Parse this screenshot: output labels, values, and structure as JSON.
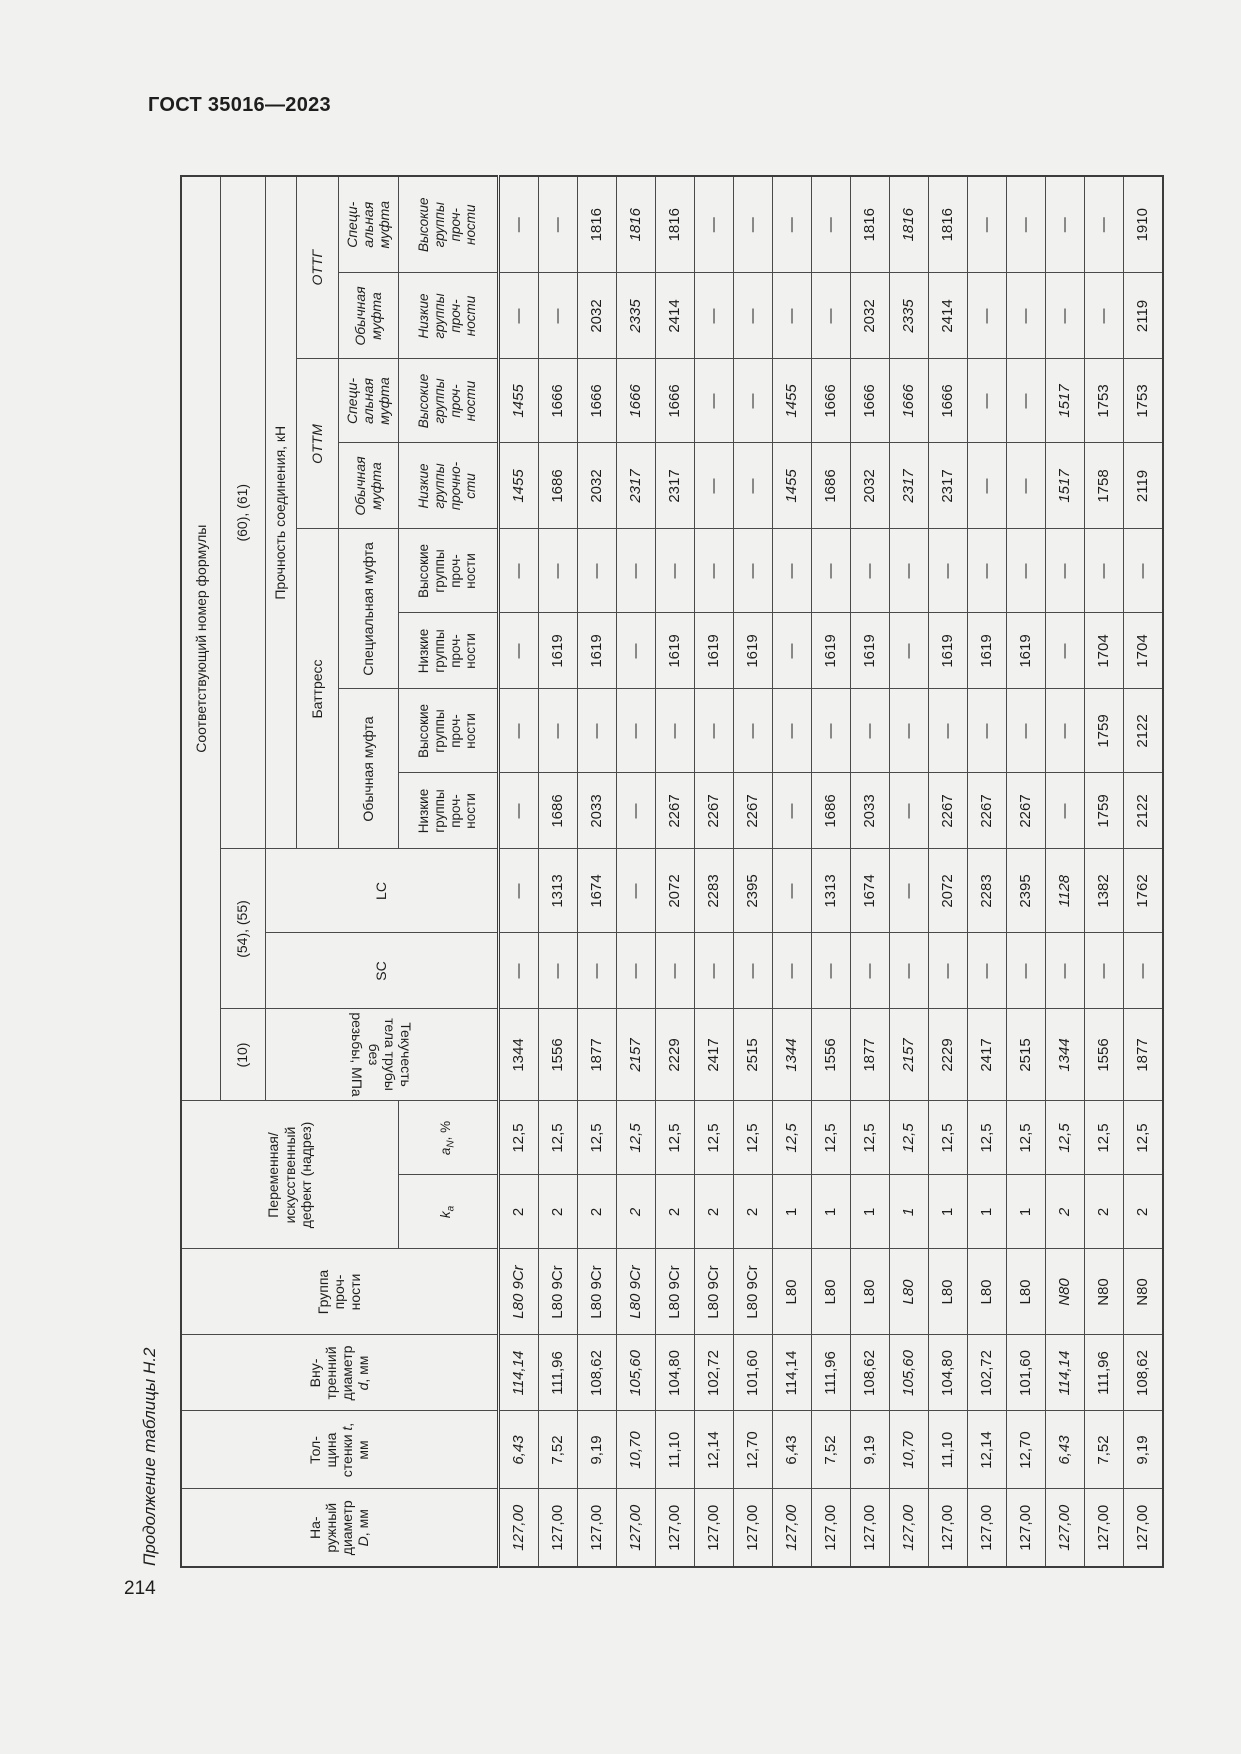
{
  "page": {
    "standard": "ГОСТ 35016—2023",
    "caption": "Продолжение таблицы Н.2",
    "number": "214"
  },
  "table": {
    "header": {
      "outer": {
        "pre": "На-\nружный\nдиаметр\n",
        "sym": "D",
        "post": ", мм"
      },
      "wall": {
        "pre": "Тол-\nщина\nстенки ",
        "sym": "t",
        "post": ",\nмм"
      },
      "inner": {
        "pre": "Вну-\nтренний\nдиаметр\n",
        "sym": "d",
        "post": ", мм"
      },
      "grade": "Группа\nпроч-\nности",
      "defect": "Переменная/\nискусственный\nдефект (надрез)",
      "ka": {
        "sym": "k",
        "sub": "а"
      },
      "an": {
        "sym": "a",
        "sub": "N",
        "post": ", %"
      },
      "formula_title": "Соответствующий номер формулы",
      "f10": "(10)",
      "f54_55": "(54), (55)",
      "f60_61": "(60), (61)",
      "yield": "Текучесть тела трубы без\nрезьбы, МПа",
      "sc": "SC",
      "lc": "LC",
      "strength": "Прочность соединения, кН",
      "buttress": "Баттресс",
      "ottm": "ОТТМ",
      "ottg": "ОТТГ",
      "usual1": "Обычная муфта",
      "special1": "Специальная муфта",
      "usual2": "Обычная\nмуфта",
      "special2": "Специ-\nальная\nмуфта",
      "low": "Низкие\nгруппы\nпроч-\nности",
      "high": "Высокие\nгруппы\nпроч-\nности",
      "low_b": "Низкие\nгруппы\nпрочно-\nсти"
    },
    "rows": [
      {
        "cells": [
          "127,00",
          "6,43",
          "114,14",
          "L80 9Cr",
          "2",
          "12,5",
          "1344",
          "—",
          "—",
          "—",
          "—",
          "—",
          "—",
          "1455",
          "1455",
          "—",
          "—"
        ],
        "italics": [
          1,
          1,
          1,
          1,
          0,
          0,
          0,
          0,
          0,
          0,
          0,
          0,
          0,
          1,
          1,
          0,
          0
        ]
      },
      {
        "cells": [
          "127,00",
          "7,52",
          "111,96",
          "L80 9Cr",
          "2",
          "12,5",
          "1556",
          "—",
          "1313",
          "1686",
          "—",
          "1619",
          "—",
          "1686",
          "1666",
          "—",
          "—"
        ],
        "italics": [
          0,
          0,
          0,
          0,
          0,
          0,
          0,
          0,
          0,
          0,
          0,
          0,
          0,
          0,
          0,
          0,
          0
        ]
      },
      {
        "cells": [
          "127,00",
          "9,19",
          "108,62",
          "L80 9Cr",
          "2",
          "12,5",
          "1877",
          "—",
          "1674",
          "2033",
          "—",
          "1619",
          "—",
          "2032",
          "1666",
          "2032",
          "1816"
        ],
        "italics": [
          0,
          0,
          0,
          0,
          0,
          0,
          0,
          0,
          0,
          0,
          0,
          0,
          0,
          0,
          0,
          0,
          0
        ]
      },
      {
        "cells": [
          "127,00",
          "10,70",
          "105,60",
          "L80 9Cr",
          "2",
          "12,5",
          "2157",
          "—",
          "—",
          "—",
          "—",
          "—",
          "—",
          "2317",
          "1666",
          "2335",
          "1816"
        ],
        "italics": [
          1,
          1,
          1,
          1,
          1,
          1,
          1,
          0,
          0,
          0,
          0,
          0,
          0,
          1,
          1,
          1,
          1
        ]
      },
      {
        "cells": [
          "127,00",
          "11,10",
          "104,80",
          "L80 9Cr",
          "2",
          "12,5",
          "2229",
          "—",
          "2072",
          "2267",
          "—",
          "1619",
          "—",
          "2317",
          "1666",
          "2414",
          "1816"
        ],
        "italics": [
          0,
          0,
          0,
          0,
          0,
          0,
          0,
          0,
          0,
          0,
          0,
          0,
          0,
          0,
          0,
          0,
          0
        ]
      },
      {
        "cells": [
          "127,00",
          "12,14",
          "102,72",
          "L80 9Cr",
          "2",
          "12,5",
          "2417",
          "—",
          "2283",
          "2267",
          "—",
          "1619",
          "—",
          "—",
          "—",
          "—",
          "—"
        ],
        "italics": [
          0,
          0,
          0,
          0,
          0,
          0,
          0,
          0,
          0,
          0,
          0,
          0,
          0,
          0,
          0,
          0,
          0
        ]
      },
      {
        "cells": [
          "127,00",
          "12,70",
          "101,60",
          "L80 9Cr",
          "2",
          "12,5",
          "2515",
          "—",
          "2395",
          "2267",
          "—",
          "1619",
          "—",
          "—",
          "—",
          "—",
          "—"
        ],
        "italics": [
          0,
          0,
          0,
          0,
          0,
          0,
          0,
          0,
          0,
          0,
          0,
          0,
          0,
          0,
          0,
          0,
          0
        ]
      },
      {
        "cells": [
          "127,00",
          "6,43",
          "114,14",
          "L80",
          "1",
          "12,5",
          "1344",
          "—",
          "—",
          "—",
          "—",
          "—",
          "—",
          "1455",
          "1455",
          "—",
          "—"
        ],
        "italics": [
          1,
          0,
          0,
          0,
          0,
          1,
          1,
          0,
          0,
          0,
          0,
          0,
          0,
          1,
          1,
          0,
          0
        ]
      },
      {
        "cells": [
          "127,00",
          "7,52",
          "111,96",
          "L80",
          "1",
          "12,5",
          "1556",
          "—",
          "1313",
          "1686",
          "—",
          "1619",
          "—",
          "1686",
          "1666",
          "—",
          "—"
        ],
        "italics": [
          0,
          0,
          0,
          0,
          0,
          0,
          0,
          0,
          0,
          0,
          0,
          0,
          0,
          0,
          0,
          0,
          0
        ]
      },
      {
        "cells": [
          "127,00",
          "9,19",
          "108,62",
          "L80",
          "1",
          "12,5",
          "1877",
          "—",
          "1674",
          "2033",
          "—",
          "1619",
          "—",
          "2032",
          "1666",
          "2032",
          "1816"
        ],
        "italics": [
          0,
          0,
          0,
          0,
          0,
          0,
          0,
          0,
          0,
          0,
          0,
          0,
          0,
          0,
          0,
          0,
          0
        ]
      },
      {
        "cells": [
          "127,00",
          "10,70",
          "105,60",
          "L80",
          "1",
          "12,5",
          "2157",
          "—",
          "—",
          "—",
          "—",
          "—",
          "—",
          "2317",
          "1666",
          "2335",
          "1816"
        ],
        "italics": [
          1,
          1,
          1,
          1,
          1,
          1,
          1,
          0,
          0,
          0,
          0,
          0,
          0,
          1,
          1,
          1,
          1
        ]
      },
      {
        "cells": [
          "127,00",
          "11,10",
          "104,80",
          "L80",
          "1",
          "12,5",
          "2229",
          "—",
          "2072",
          "2267",
          "—",
          "1619",
          "—",
          "2317",
          "1666",
          "2414",
          "1816"
        ],
        "italics": [
          0,
          0,
          0,
          0,
          0,
          0,
          0,
          0,
          0,
          0,
          0,
          0,
          0,
          0,
          0,
          0,
          0
        ]
      },
      {
        "cells": [
          "127,00",
          "12,14",
          "102,72",
          "L80",
          "1",
          "12,5",
          "2417",
          "—",
          "2283",
          "2267",
          "—",
          "1619",
          "—",
          "—",
          "—",
          "—",
          "—"
        ],
        "italics": [
          0,
          0,
          0,
          0,
          0,
          0,
          0,
          0,
          0,
          0,
          0,
          0,
          0,
          0,
          0,
          0,
          0
        ]
      },
      {
        "cells": [
          "127,00",
          "12,70",
          "101,60",
          "L80",
          "1",
          "12,5",
          "2515",
          "—",
          "2395",
          "2267",
          "—",
          "1619",
          "—",
          "—",
          "—",
          "—",
          "—"
        ],
        "italics": [
          0,
          0,
          0,
          0,
          0,
          0,
          0,
          0,
          0,
          0,
          0,
          0,
          0,
          0,
          0,
          0,
          0
        ]
      },
      {
        "cells": [
          "127,00",
          "6,43",
          "114,14",
          "N80",
          "2",
          "12,5",
          "1344",
          "—",
          "1128",
          "—",
          "—",
          "—",
          "—",
          "1517",
          "1517",
          "—",
          "—"
        ],
        "italics": [
          1,
          1,
          1,
          1,
          1,
          1,
          1,
          0,
          1,
          0,
          0,
          0,
          0,
          1,
          1,
          0,
          0
        ]
      },
      {
        "cells": [
          "127,00",
          "7,52",
          "111,96",
          "N80",
          "2",
          "12,5",
          "1556",
          "—",
          "1382",
          "1759",
          "1759",
          "1704",
          "—",
          "1758",
          "1753",
          "—",
          "—"
        ],
        "italics": [
          0,
          0,
          0,
          0,
          0,
          0,
          0,
          0,
          0,
          0,
          0,
          0,
          0,
          0,
          0,
          0,
          0
        ]
      },
      {
        "cells": [
          "127,00",
          "9,19",
          "108,62",
          "N80",
          "2",
          "12,5",
          "1877",
          "—",
          "1762",
          "2122",
          "2122",
          "1704",
          "—",
          "2119",
          "1753",
          "2119",
          "1910"
        ],
        "italics": [
          0,
          0,
          0,
          0,
          0,
          0,
          0,
          0,
          0,
          0,
          0,
          0,
          0,
          0,
          0,
          0,
          0
        ]
      }
    ]
  }
}
